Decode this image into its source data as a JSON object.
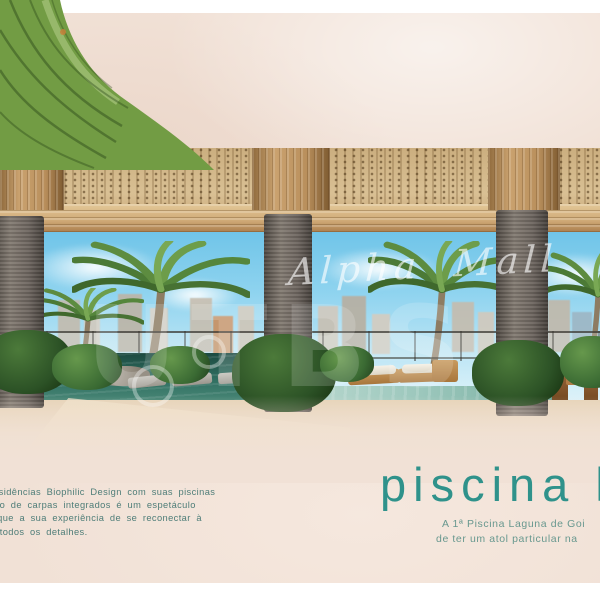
{
  "watermarks": {
    "script": "Alpha Mall",
    "letters": "UTBS"
  },
  "heading": {
    "text": "piscina la",
    "color": "#2f928b"
  },
  "subheading": {
    "line1": "A 1ª Piscina Laguna de Goi",
    "line2": "de ter um atol particular na"
  },
  "paragraph": {
    "line1": "Residências Biophilic Design com suas piscinas",
    "line2": "lago de carpas integrados é um espetáculo",
    "line3": "a que a sua experiência de se reconectar à",
    "line4": "m todos os detalhes."
  },
  "colors": {
    "sand_background": "#f1e1d6",
    "heading_teal": "#2f928b",
    "body_text_teal": "#4e7d78",
    "subtext_teal": "#68988f",
    "sky_blue": "#8ed3ef",
    "pool_dark_teal": "#2f6e60",
    "pool_light_teal": "#9dc8bd",
    "wood_ceiling": "#d9c094",
    "column_gray": "#6e6660",
    "leaf_green": "#729c44"
  }
}
